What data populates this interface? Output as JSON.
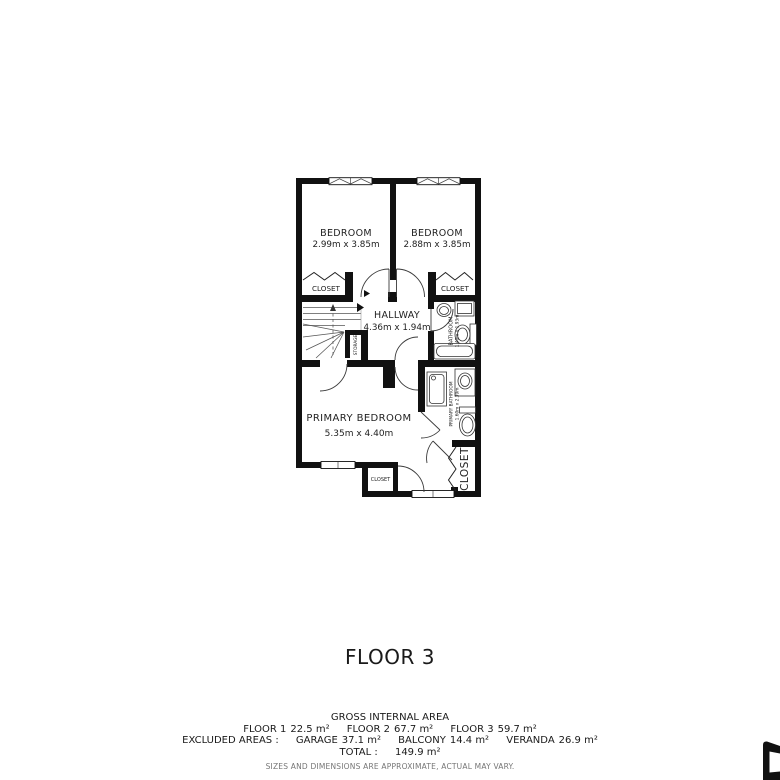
{
  "plan": {
    "bedroom_left": {
      "name": "BEDROOM",
      "dims": "2.99m x 3.85m"
    },
    "bedroom_right": {
      "name": "BEDROOM",
      "dims": "2.88m x 3.85m"
    },
    "closet_left": {
      "name": "CLOSET"
    },
    "closet_right": {
      "name": "CLOSET"
    },
    "hallway": {
      "name": "HALLWAY",
      "dims": "4.36m x 1.94m"
    },
    "storage": {
      "name": "STORAGE"
    },
    "bathroom": {
      "name": "BATHROOM",
      "dims": "1.40m x 1.93m"
    },
    "primary_bathroom": {
      "name": "PRIMARY BATHROOM",
      "dims": "1.60m x 2.39m"
    },
    "primary_bedroom": {
      "name": "PRIMARY BEDROOM",
      "dims": "5.35m x 4.40m"
    },
    "closet_small": {
      "name": "CLOSET"
    },
    "closet_primary": {
      "name": "CLOSET"
    }
  },
  "title": "FLOOR 3",
  "summary": {
    "heading": "GROSS INTERNAL AREA",
    "floors": [
      {
        "label": "FLOOR 1",
        "value": "22.5 m²"
      },
      {
        "label": "FLOOR 2",
        "value": "67.7 m²"
      },
      {
        "label": "FLOOR 3",
        "value": "59.7 m²"
      }
    ],
    "excluded_label": "EXCLUDED AREAS :",
    "excluded": [
      {
        "label": "GARAGE",
        "value": "37.1 m²"
      },
      {
        "label": "BALCONY",
        "value": "14.4 m²"
      },
      {
        "label": "VERANDA",
        "value": "26.9 m²"
      }
    ],
    "total_label": "TOTAL :",
    "total_value": "149.9 m²",
    "disclaimer": "SIZES AND DIMENSIONS ARE APPROXIMATE, ACTUAL MAY VARY."
  },
  "colors": {
    "wall": "#111111",
    "label": "#222222",
    "muted": "#767676"
  }
}
